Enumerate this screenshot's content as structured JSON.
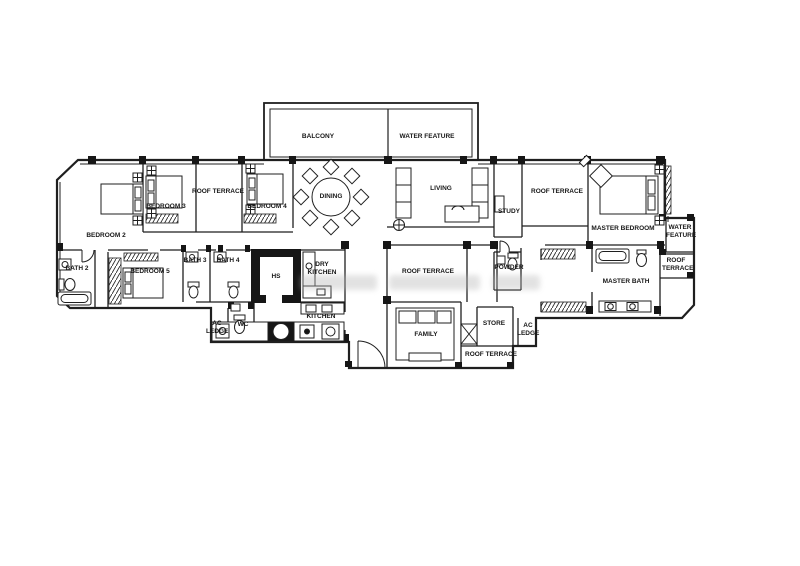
{
  "drawing": {
    "kind": "apartment floor plan",
    "line_color": "#1f1f1f",
    "background_color": "#ffffff"
  },
  "labels": {
    "balcony": "BALCONY",
    "water_feature_top": "WATER FEATURE",
    "bedroom_2": "BEDROOM 2",
    "bedroom_3": "BEDROOM 3",
    "roof_terrace_top_left": "ROOF TERRACE",
    "bedroom_4": "BEDROOM 4",
    "dining": "DINING",
    "living": "LIVING",
    "study": "STUDY",
    "roof_terrace_top_right": "ROOF TERRACE",
    "master_bedroom": "MASTER BEDROOM",
    "water_feature_side": "WATER FEATURE",
    "bath_2": "BATH 2",
    "bedroom_5": "BEDROOM 5",
    "bath_3": "BATH 3",
    "bath_4": "BATH 4",
    "hs": "HS",
    "dry_kitchen": "DRY KITCHEN",
    "roof_terrace_center": "ROOF TERRACE",
    "powder": "POWDER",
    "master_bath": "MASTER BATH",
    "roof_terrace_side": "ROOF TERRACE",
    "ac_ledge_left": "AC LEDGE",
    "wc": "WC",
    "kitchen": "KITCHEN",
    "family": "FAMILY",
    "store": "STORE",
    "ac_ledge_right": "AC LEDGE",
    "roof_terrace_bottom": "ROOF TERRACE"
  }
}
